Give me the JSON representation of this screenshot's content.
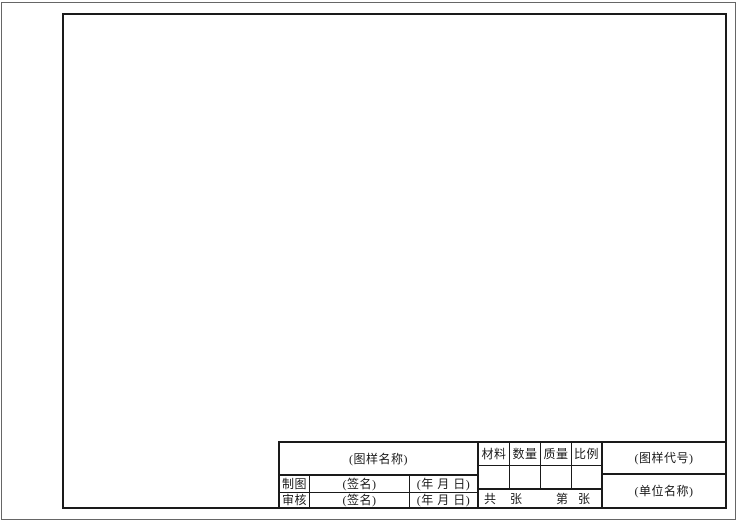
{
  "colors": {
    "line": "#1a1a1a",
    "paper_edge": "#666666",
    "background": "#ffffff"
  },
  "title_block": {
    "drawing_name": "(图样名称)",
    "rows": {
      "draft": {
        "label": "制图",
        "signature": "(签名)",
        "date": "(年 月 日)"
      },
      "check": {
        "label": "审核",
        "signature": "(签名)",
        "date": "(年 月 日)"
      }
    },
    "spec_headers": {
      "material": "材料",
      "quantity": "数量",
      "mass": "质量",
      "scale": "比例"
    },
    "spec_values": {
      "material": "",
      "quantity": "",
      "mass": "",
      "scale": ""
    },
    "sheets": {
      "total_label": "共",
      "total_unit": "张",
      "index_label": "第",
      "index_unit": "张"
    },
    "drawing_code": "(图样代号)",
    "company_name": "(单位名称)"
  }
}
